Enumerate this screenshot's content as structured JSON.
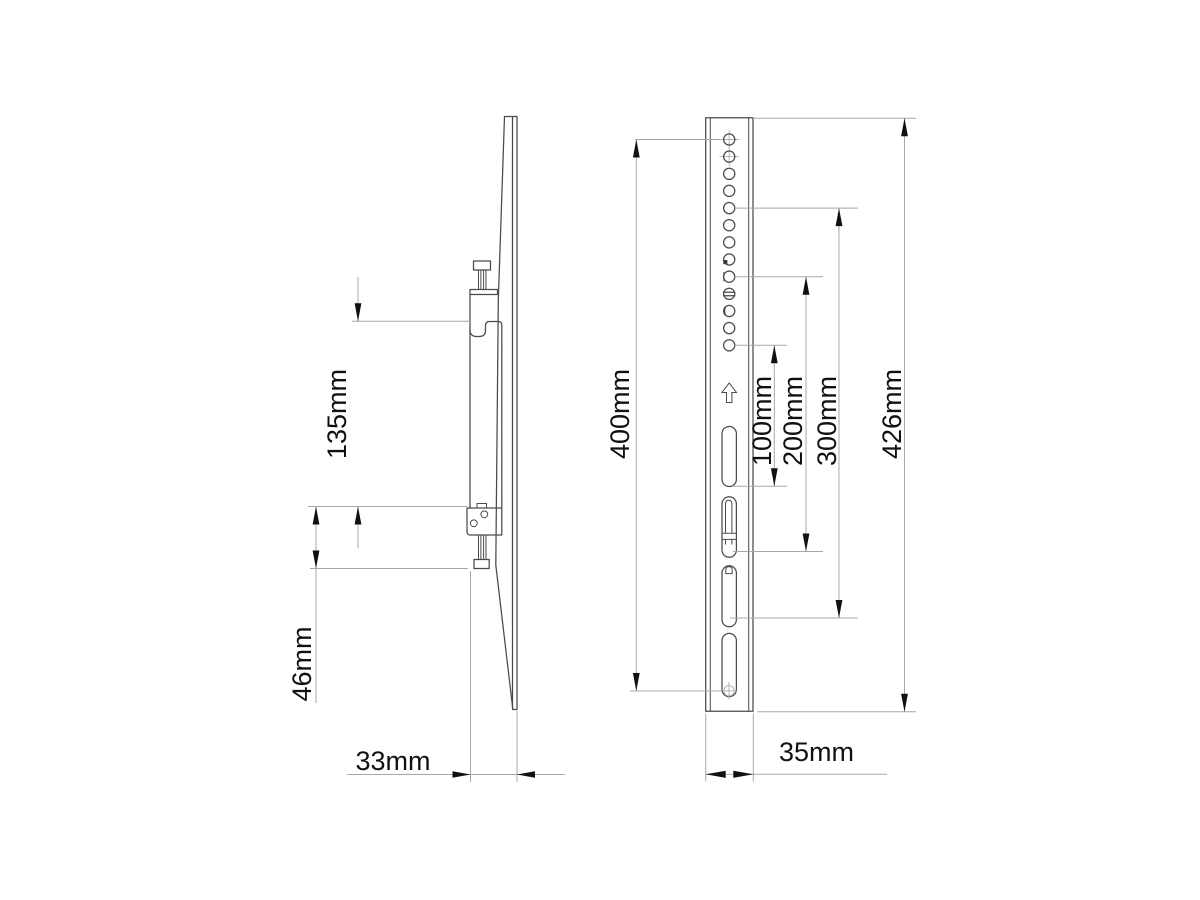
{
  "side_view": {
    "title": "side-profile-view",
    "dimensions": {
      "hook_to_bracket_spacing": "135mm",
      "lower_bracket_height": "46mm",
      "profile_depth": "33mm"
    }
  },
  "front_view": {
    "title": "front-view",
    "dimensions": {
      "hole_span": "400mm",
      "slot_offset_1": "100mm",
      "slot_offset_2": "200mm",
      "slot_offset_3": "300mm",
      "total_height": "426mm",
      "rail_width": "35mm"
    },
    "mounting_hole_count": 13,
    "slot_count": 4
  },
  "colors": {
    "part_line": "#4a4a4a",
    "dimension_line": "#a8a8a8",
    "arrow": "#111111",
    "text": "#111111",
    "background": "#ffffff"
  }
}
